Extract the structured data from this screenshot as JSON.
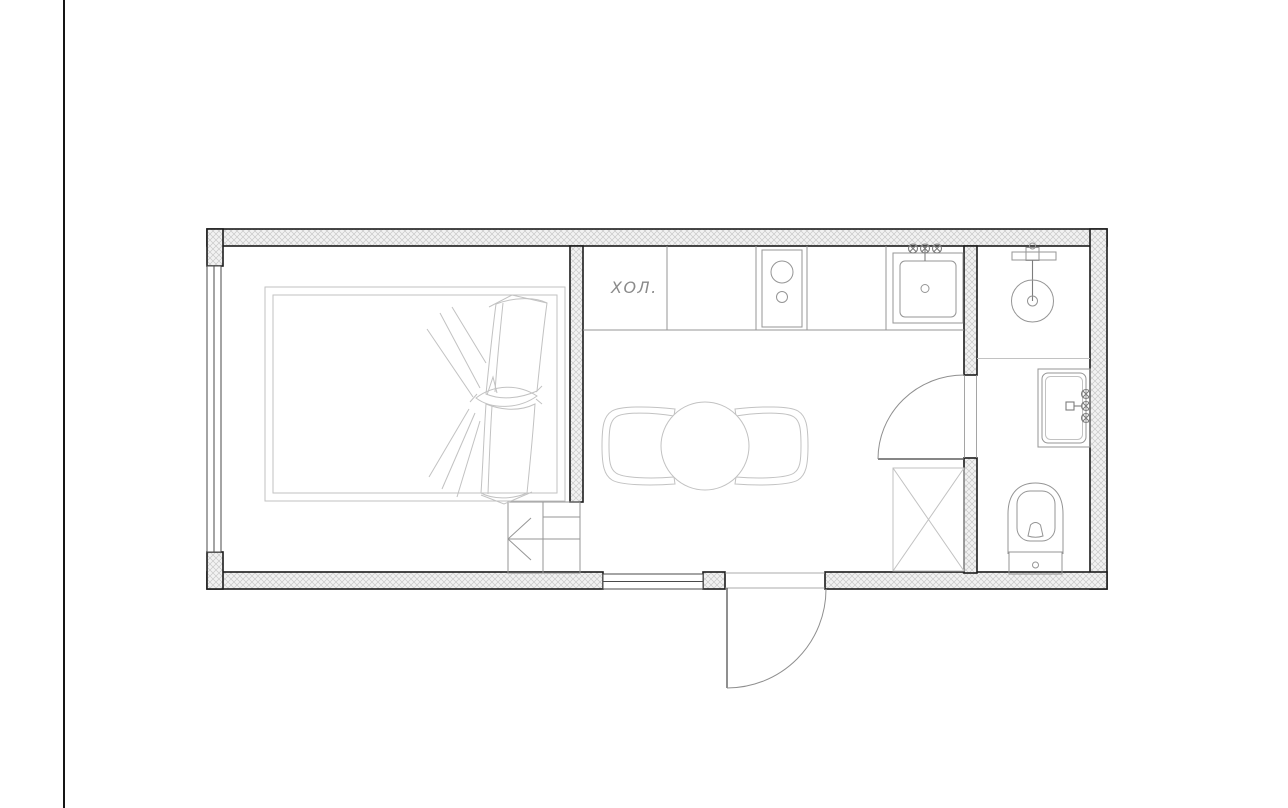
{
  "drawing": {
    "type": "apartment-floor-plan",
    "label_fridge": "ХОЛ.",
    "colors": {
      "wall_outline": "#1c1c1c",
      "wall_hatch": "#c9c9c9",
      "fixture_line": "#959595",
      "furniture_line": "#c2c2c2",
      "label_text": "#8a8a8a",
      "page_edge_line": "#151515",
      "door_line": "#8f8f8f",
      "leaf_line": "#5f5f5f",
      "window_line": "#4a4a4a"
    },
    "rooms": [
      {
        "name": "bedroom",
        "features": [
          "double-bed-with-duvet",
          "full-height-window-left",
          "entry-wardrobe-with-direction-arrow"
        ]
      },
      {
        "name": "kitchen-living",
        "features": [
          "refrigerator-bay",
          "kitchen-counter-run",
          "cooktop-two-burners",
          "kitchen-sink-with-mixer-valves",
          "round-dining-table",
          "two-armchairs",
          "utility-shaft-crossed",
          "window-in-bottom-wall",
          "entry-door-swing"
        ]
      },
      {
        "name": "bathroom",
        "features": [
          "overhead-shower-with-mixer-bar",
          "shower-zone-divider",
          "washbasin-vanity-with-wall-mixer",
          "toilet-with-cistern",
          "door-swing-into-living"
        ]
      }
    ]
  }
}
